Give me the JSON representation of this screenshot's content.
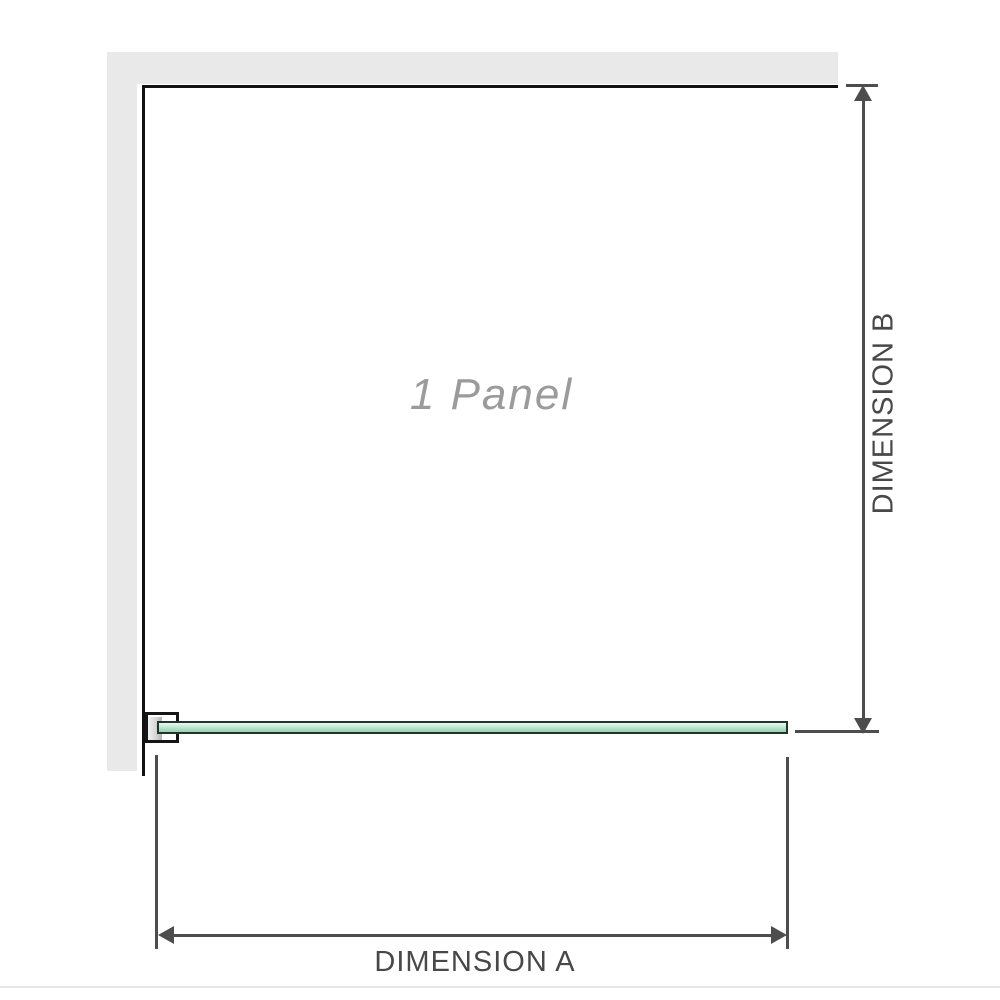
{
  "diagram": {
    "panel_label": "1 Panel",
    "dimension_a_label": "DIMENSION A",
    "dimension_b_label": "DIMENSION B"
  },
  "icons": {
    "dimension_b_up_arrow": "css-triangle-up",
    "dimension_b_down_arrow": "css-triangle-down",
    "dimension_a_left_arrow": "css-triangle-left",
    "dimension_a_right_arrow": "css-triangle-right"
  },
  "colors": {
    "wall_fill": "#e9e9e9",
    "panel_border": "#111111",
    "bracket_border": "#151515",
    "glass_border": "#22352b",
    "glass_green_light": "#ecf8f1",
    "glass_green_dark": "#9ad2b1",
    "dimension_line": "#4d4d4d",
    "label_text": "#484848",
    "panel_label_text": "#9b9b9b",
    "divider": "#e6e6e6"
  }
}
